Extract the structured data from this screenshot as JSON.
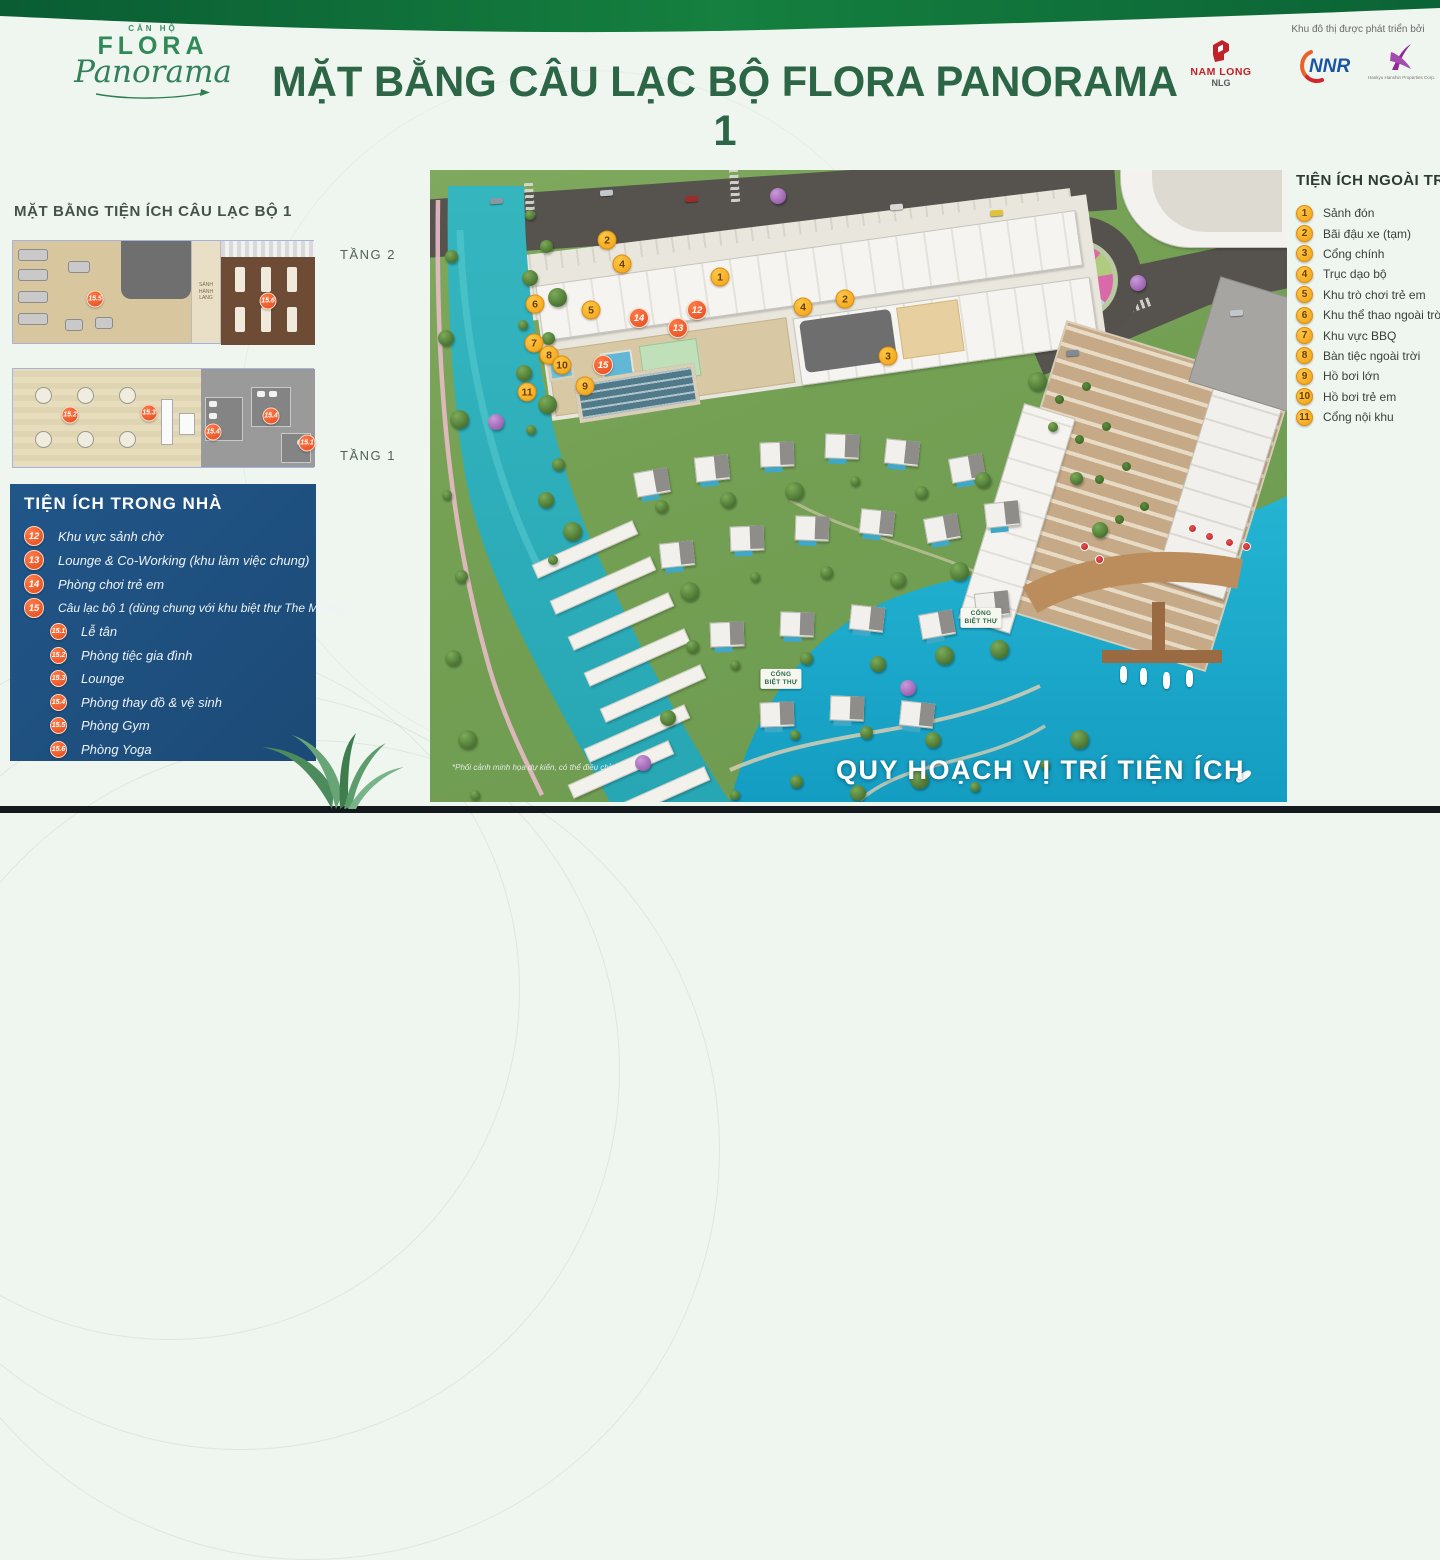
{
  "header": {
    "title": "MẶT BẰNG CÂU LẠC BỘ FLORA PANORAMA 1",
    "brand": {
      "top": "CĂN HỘ",
      "name": "FLORA",
      "script": "Panorama"
    },
    "partners_note": "Khu đô thị được phát triển bởi",
    "partners": [
      {
        "name": "NAM LONG",
        "sub": "NLG"
      },
      {
        "name": "NNR"
      },
      {
        "name": "Hankyu Hanshin Properties Corp."
      }
    ]
  },
  "left_panel": {
    "title": "MẶT BẰNG TIỆN ÍCH CÂU LẠC BỘ 1",
    "floor2": {
      "label": "TẦNG 2",
      "lobby": "SẢNH HÀNH LANG",
      "markers": [
        {
          "num": "15.5",
          "x": 82,
          "y": 58
        },
        {
          "num": "15.6",
          "x": 255,
          "y": 60
        }
      ]
    },
    "floor1": {
      "label": "TẦNG 1",
      "markers": [
        {
          "num": "15.2",
          "x": 57,
          "y": 46
        },
        {
          "num": "15.3",
          "x": 136,
          "y": 44
        },
        {
          "num": "15.4",
          "x": 200,
          "y": 63
        },
        {
          "num": "15.4",
          "x": 258,
          "y": 47
        },
        {
          "num": "15.1",
          "x": 294,
          "y": 74
        }
      ]
    }
  },
  "indoor": {
    "title": "TIỆN ÍCH TRONG NHÀ",
    "items": [
      {
        "num": "12",
        "label": "Khu vực sảnh chờ"
      },
      {
        "num": "13",
        "label": "Lounge & Co-Working (khu làm việc chung)"
      },
      {
        "num": "14",
        "label": "Phòng chơi trẻ em"
      },
      {
        "num": "15",
        "label": "Câu lạc bộ 1 (dùng chung với khu biệt thự The Mizuki)"
      }
    ],
    "sub_items": [
      {
        "num": "15.1",
        "label": "Lễ tân"
      },
      {
        "num": "15.2",
        "label": "Phòng tiệc gia đình"
      },
      {
        "num": "15.3",
        "label": "Lounge"
      },
      {
        "num": "15.4",
        "label": "Phòng thay đồ & vệ sinh"
      },
      {
        "num": "15.5",
        "label": "Phòng Gym"
      },
      {
        "num": "15.6",
        "label": "Phòng Yoga"
      }
    ]
  },
  "outdoor": {
    "title": "TIỆN ÍCH NGOÀI TRỜI",
    "items": [
      {
        "num": "1",
        "label": "Sảnh đón"
      },
      {
        "num": "2",
        "label": "Bãi đậu xe (tạm)"
      },
      {
        "num": "3",
        "label": "Cổng chính"
      },
      {
        "num": "4",
        "label": "Trục dạo bộ"
      },
      {
        "num": "5",
        "label": "Khu trò chơi trẻ em"
      },
      {
        "num": "6",
        "label": "Khu thể thao ngoài trời"
      },
      {
        "num": "7",
        "label": "Khu vực BBQ"
      },
      {
        "num": "8",
        "label": "Bàn tiệc ngoài trời"
      },
      {
        "num": "9",
        "label": "Hồ bơi lớn"
      },
      {
        "num": "10",
        "label": "Hồ bơi trẻ em"
      },
      {
        "num": "11",
        "label": "Cổng nội khu"
      }
    ]
  },
  "map": {
    "caption": "*Phối cảnh minh họa dự kiến, có thể điều chỉnh.",
    "overlay_title": "QUY HOẠCH VỊ TRÍ TIỆN ÍCH",
    "gates": [
      {
        "label": "CỔNG\nBIỆT THỰ",
        "x": 351,
        "y": 509
      },
      {
        "label": "CỔNG\nBIỆT THỰ",
        "x": 551,
        "y": 448
      }
    ],
    "markers": [
      {
        "num": "1",
        "kind": "outdoor",
        "x": 290,
        "y": 107
      },
      {
        "num": "2",
        "kind": "outdoor",
        "x": 177,
        "y": 70
      },
      {
        "num": "2",
        "kind": "outdoor",
        "x": 415,
        "y": 129
      },
      {
        "num": "3",
        "kind": "outdoor",
        "x": 458,
        "y": 186
      },
      {
        "num": "4",
        "kind": "outdoor",
        "x": 192,
        "y": 94
      },
      {
        "num": "4",
        "kind": "outdoor",
        "x": 373,
        "y": 137
      },
      {
        "num": "5",
        "kind": "outdoor",
        "x": 161,
        "y": 140
      },
      {
        "num": "6",
        "kind": "outdoor",
        "x": 105,
        "y": 134
      },
      {
        "num": "7",
        "kind": "outdoor",
        "x": 104,
        "y": 173
      },
      {
        "num": "8",
        "kind": "outdoor",
        "x": 119,
        "y": 185
      },
      {
        "num": "9",
        "kind": "outdoor",
        "x": 155,
        "y": 216
      },
      {
        "num": "10",
        "kind": "outdoor",
        "x": 132,
        "y": 195
      },
      {
        "num": "11",
        "kind": "outdoor",
        "x": 97,
        "y": 222
      },
      {
        "num": "12",
        "kind": "indoor",
        "x": 267,
        "y": 140
      },
      {
        "num": "13",
        "kind": "indoor",
        "x": 248,
        "y": 158
      },
      {
        "num": "14",
        "kind": "indoor",
        "x": 209,
        "y": 148
      },
      {
        "num": "15",
        "kind": "indoor",
        "x": 173,
        "y": 195
      }
    ]
  },
  "colors": {
    "title_green": "#2d6647",
    "ribbon_green": "#0d6b3c",
    "panel_blue": "#1e4e7d",
    "marker_orange": "#f2a013",
    "marker_red": "#e2481d",
    "canal": "#2fb0ba",
    "lake": "#1aa9c9"
  }
}
